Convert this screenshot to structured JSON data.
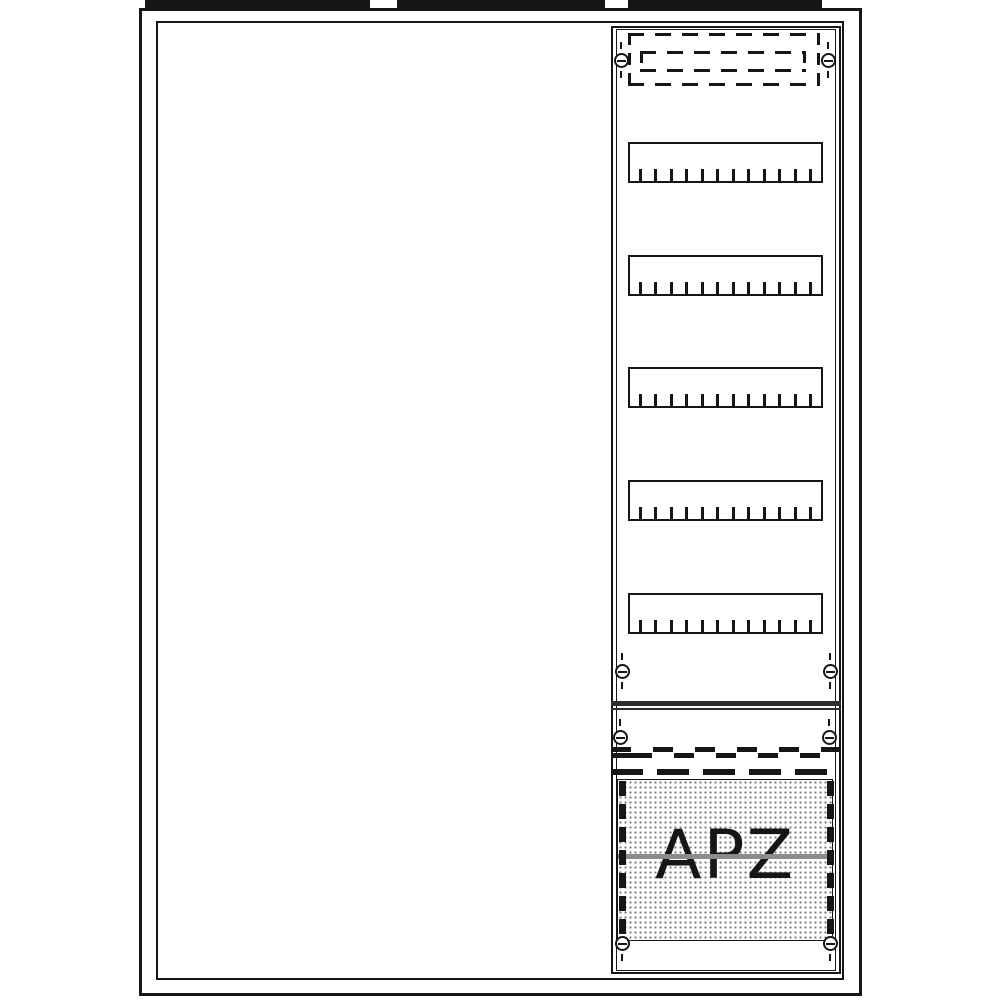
{
  "diagram": {
    "kind": "distribution-board-front-view",
    "apz": {
      "label": "APZ"
    },
    "din": {
      "row_count": 5,
      "ticks_per_row": 12
    },
    "colors": {
      "background": "#ffffff",
      "ink": "#161616",
      "divider": "#2e2e2e",
      "stipple_dot": "#777777",
      "apz_line": "#8c8c8c"
    }
  }
}
